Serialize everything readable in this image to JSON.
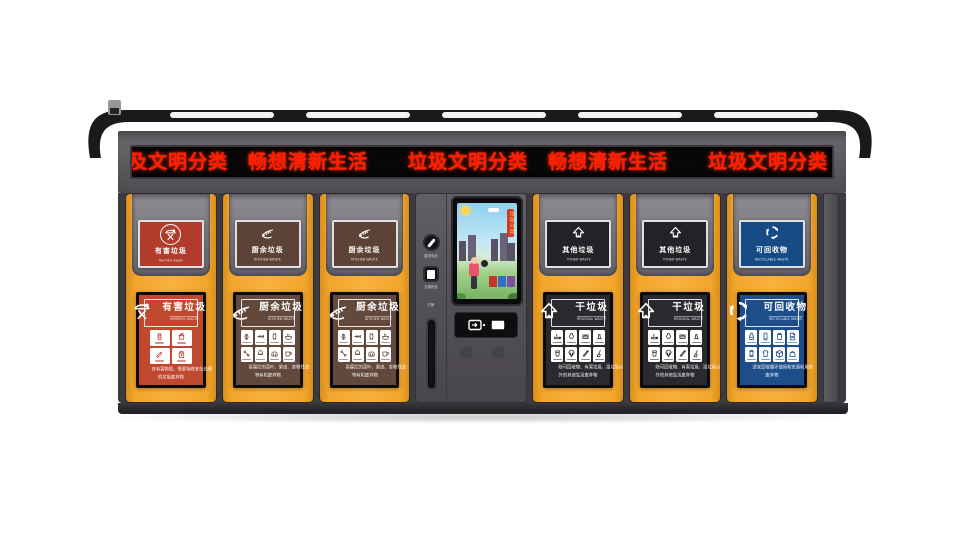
{
  "scene": {
    "background": "#ffffff"
  },
  "machine": {
    "name": "智能垃圾分类回收站",
    "roof": {
      "light_strips": 5,
      "camera_icon": "camera-icon"
    },
    "led_ticker": {
      "text": "及文明分类　畅想清新生活　　垃圾文明分类　畅想清新生活　　垃圾文明分类　畅想清新生",
      "color": "#ff1e00",
      "background": "#070707"
    },
    "colors": {
      "cabinet": "#3d3a40",
      "door_yellow": "#f3a52c",
      "harmful_red": "#b23c2b",
      "kitchen_brown": "#5d4337",
      "other_black": "#2a292d",
      "recyclable_blue": "#1d4e8a"
    },
    "console": {
      "battery_label": "废旧电池",
      "battery_icon": "battery-slot-icon",
      "medicine_label": "过期药品",
      "medicine_icon": "medicine-slot-icon",
      "tube_label": "灯管",
      "screen_banner": "垃圾分类",
      "card_reader_icon": "card-reader-icon"
    },
    "doors": [
      {
        "kind": "harmful-waste",
        "color": "#b23c2b",
        "poster_color": "#c0482f",
        "sign": {
          "icon": "harmful-waste-icon",
          "title": "有害垃圾",
          "subtitle": "Harmful waste"
        },
        "poster": {
          "icon": "harmful-waste-icon",
          "title": "有害垃圾",
          "subtitle": "HARMFUL WASTE",
          "caption_line1": "含有害物质，需要特殊安全处理",
          "caption_line2": "的垃圾废弃物",
          "items": [
            "waste-battery",
            "paint-bucket",
            "lamp-tube",
            "expired-medicine"
          ]
        }
      },
      {
        "kind": "kitchen-waste",
        "color": "#5d4337",
        "poster_color": "#63493c",
        "sign": {
          "icon": "kitchen-waste-icon",
          "title": "厨余垃圾",
          "subtitle": "KITCHEN WASTE"
        },
        "poster": {
          "icon": "kitchen-waste-icon",
          "title": "厨余垃圾",
          "subtitle": "KITCHEN WASTE",
          "caption_line1": "易腐烂的菜叶、果皮、食物残渣",
          "caption_line2": "等有机废弃物",
          "items": [
            "vegetable-leaf",
            "fish-bone",
            "apple-core",
            "leftovers",
            "bone",
            "eggshell",
            "bread",
            "tea-residue"
          ]
        }
      },
      {
        "kind": "kitchen-waste",
        "color": "#5d4337",
        "poster_color": "#63493c",
        "sign": {
          "icon": "kitchen-waste-icon",
          "title": "厨余垃圾",
          "subtitle": "KITCHEN WASTE"
        },
        "poster": {
          "icon": "kitchen-waste-icon",
          "title": "厨余垃圾",
          "subtitle": "KITCHEN WASTE",
          "caption_line1": "易腐烂的菜叶、果皮、食物残渣",
          "caption_line2": "等有机废弃物",
          "items": [
            "vegetable-leaf",
            "fish-bone",
            "apple-core",
            "leftovers",
            "bone",
            "eggshell",
            "bread",
            "tea-residue"
          ]
        }
      },
      {
        "kind": "other-waste",
        "color": "#232226",
        "poster_color": "#2a292d",
        "sign": {
          "icon": "other-waste-icon",
          "title": "其他垃圾",
          "subtitle": "OTHER WASTE"
        },
        "poster": {
          "icon": "other-waste-icon",
          "title": "干垃圾",
          "subtitle": "RESIDUAL WASTE",
          "caption_line1": "除可回收物、有害垃圾、湿垃圾以",
          "caption_line2": "外的其他生活废弃物",
          "items": [
            "cigarette-butt",
            "ceramic",
            "tissue-paper",
            "dust",
            "disposable-cup",
            "shell",
            "pen",
            "broom"
          ]
        }
      },
      {
        "kind": "other-waste",
        "color": "#232226",
        "poster_color": "#2a292d",
        "sign": {
          "icon": "other-waste-icon",
          "title": "其他垃圾",
          "subtitle": "OTHER WASTE"
        },
        "poster": {
          "icon": "other-waste-icon",
          "title": "干垃圾",
          "subtitle": "RESIDUAL WASTE",
          "caption_line1": "除可回收物、有害垃圾、湿垃圾以",
          "caption_line2": "外的其他生活废弃物",
          "items": [
            "cigarette-butt",
            "ceramic",
            "tissue-paper",
            "dust",
            "disposable-cup",
            "shell",
            "pen",
            "broom"
          ]
        }
      },
      {
        "kind": "recyclable-waste",
        "color": "#174b86",
        "poster_color": "#1d4e8a",
        "sign": {
          "icon": "recyclable-icon",
          "title": "可回收物",
          "subtitle": "RECYCLABLE WASTE"
        },
        "poster": {
          "icon": "recyclable-icon",
          "title": "可回收物",
          "subtitle": "RECYCLABLE WASTE",
          "caption_line1": "适宜回收循环使用和资源利用的",
          "caption_line2": "废弃物",
          "items": [
            "plastic-bottle",
            "mobile-phone",
            "glass-jar",
            "paper",
            "tin-can",
            "clothes",
            "carton-box",
            "handbag"
          ]
        }
      }
    ]
  }
}
